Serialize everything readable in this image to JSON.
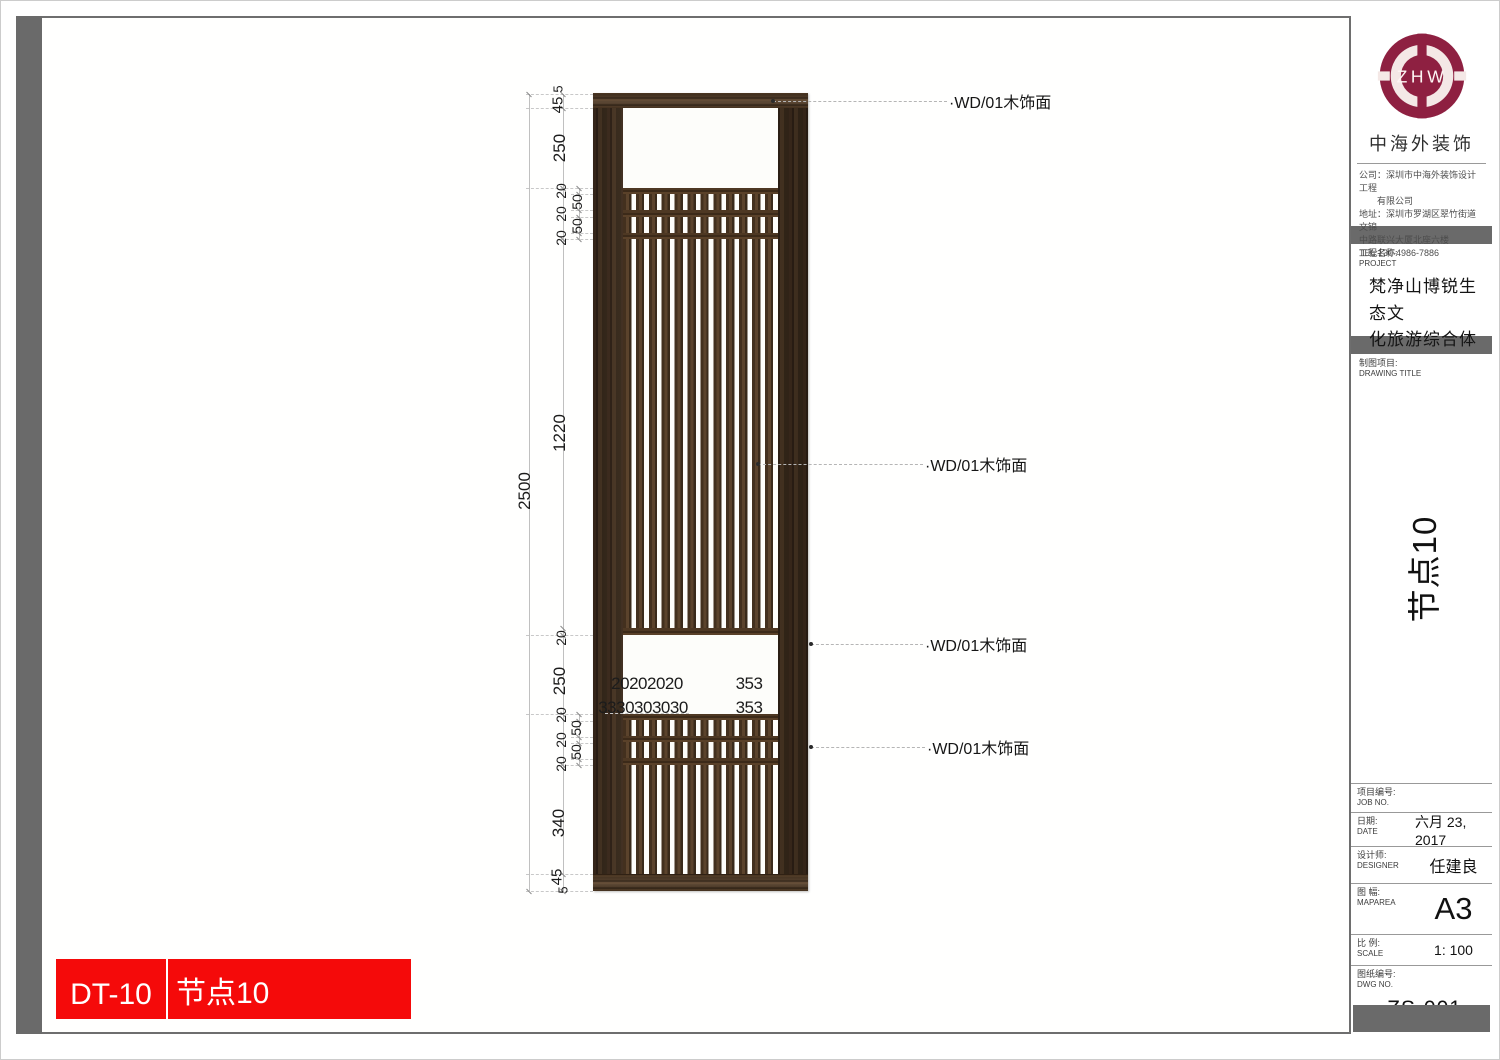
{
  "colors": {
    "accent_red": "#f50a0a",
    "logo_maroon": "#8e2041",
    "frame_gray": "#6a6a6a",
    "wood_dark": "#3a2817",
    "wood_light": "#5b432c"
  },
  "footer": {
    "code": "DT-10",
    "title": "节点10"
  },
  "titleblock": {
    "logo_text": "ZHW",
    "company_name": "中海外装饰",
    "company_lines": [
      "公司：深圳市中海外装饰设计工程",
      "有限公司",
      "地址：深圳市罗湖区翠竹街道文锦",
      "中路联兴大厦北座六楼",
      "TEL:130-4986-7886"
    ],
    "project_label_zh": "工程名称:",
    "project_label_en": "PROJECT",
    "project_name_line1": "梵净山博锐生态文",
    "project_name_line2": "化旅游综合体",
    "drawing_title_zh": "制图项目:",
    "drawing_title_en": "DRAWING TITLE",
    "side_title": "节点10",
    "fields": [
      {
        "zh": "项目编号:",
        "en": "JOB NO.",
        "value": ""
      },
      {
        "zh": "日期:",
        "en": "DATE",
        "value": "六月 23, 2017"
      },
      {
        "zh": "设计师:",
        "en": "DESIGNER",
        "value": "任建良"
      },
      {
        "zh": "图 幅:",
        "en": "MAPAREA",
        "value": "A3"
      },
      {
        "zh": "比 例:",
        "en": "SCALE",
        "value": "1: 100"
      }
    ],
    "dwg": {
      "zh": "图纸编号:",
      "en": "DWG NO.",
      "value": "ZS-001"
    }
  },
  "drawing": {
    "annotations": [
      {
        "text": "·WD/01木饰面",
        "ly": 100,
        "x1": 772,
        "x2": 946,
        "tx": 948,
        "dot_x": 772
      },
      {
        "text": "·WD/01木饰面",
        "ly": 463,
        "x1": 757,
        "x2": 922,
        "tx": 924,
        "dot_x": 757
      },
      {
        "text": "·WD/01木饰面",
        "ly": 643,
        "x1": 810,
        "x2": 922,
        "tx": 924,
        "dot_x": 810
      },
      {
        "text": "·WD/01木饰面",
        "ly": 746,
        "x1": 810,
        "x2": 924,
        "tx": 926,
        "dot_x": 810
      }
    ],
    "dim_labels": [
      {
        "t": "5",
        "x": 557,
        "y": 88,
        "rot": true,
        "fs": 13
      },
      {
        "t": "45",
        "x": 557,
        "y": 104,
        "rot": true,
        "fs": 15
      },
      {
        "t": "250",
        "x": 559,
        "y": 147,
        "rot": true,
        "fs": 17
      },
      {
        "t": "20",
        "x": 560,
        "y": 190,
        "rot": true,
        "fs": 14
      },
      {
        "t": "50",
        "x": 576,
        "y": 201,
        "rot": true,
        "fs": 14
      },
      {
        "t": "20",
        "x": 560,
        "y": 213,
        "rot": true,
        "fs": 14
      },
      {
        "t": "50",
        "x": 576,
        "y": 225,
        "rot": true,
        "fs": 14
      },
      {
        "t": "20",
        "x": 560,
        "y": 237,
        "rot": true,
        "fs": 14
      },
      {
        "t": "1220",
        "x": 559,
        "y": 432,
        "rot": true,
        "fs": 17
      },
      {
        "t": "2500",
        "x": 524,
        "y": 490,
        "rot": true,
        "fs": 17
      },
      {
        "t": "20",
        "x": 560,
        "y": 637,
        "rot": true,
        "fs": 14
      },
      {
        "t": "250",
        "x": 559,
        "y": 680,
        "rot": true,
        "fs": 17
      },
      {
        "t": "20",
        "x": 560,
        "y": 714,
        "rot": true,
        "fs": 14
      },
      {
        "t": "50",
        "x": 575,
        "y": 727,
        "rot": true,
        "fs": 14
      },
      {
        "t": "20",
        "x": 560,
        "y": 739,
        "rot": true,
        "fs": 14
      },
      {
        "t": "50",
        "x": 575,
        "y": 751,
        "rot": true,
        "fs": 14
      },
      {
        "t": "20",
        "x": 560,
        "y": 763,
        "rot": true,
        "fs": 14
      },
      {
        "t": "340",
        "x": 558,
        "y": 822,
        "rot": true,
        "fs": 17
      },
      {
        "t": "45",
        "x": 556,
        "y": 876,
        "rot": true,
        "fs": 15
      },
      {
        "t": "5",
        "x": 562,
        "y": 889,
        "rot": true,
        "fs": 13
      },
      {
        "t": "20202020",
        "x": 646,
        "y": 683,
        "rot": false,
        "fs": 17
      },
      {
        "t": "353",
        "x": 748,
        "y": 683,
        "rot": false,
        "fs": 17
      },
      {
        "t": "3330303030",
        "x": 642,
        "y": 707,
        "rot": false,
        "fs": 17
      },
      {
        "t": "353",
        "x": 748,
        "y": 707,
        "rot": false,
        "fs": 17
      }
    ]
  }
}
